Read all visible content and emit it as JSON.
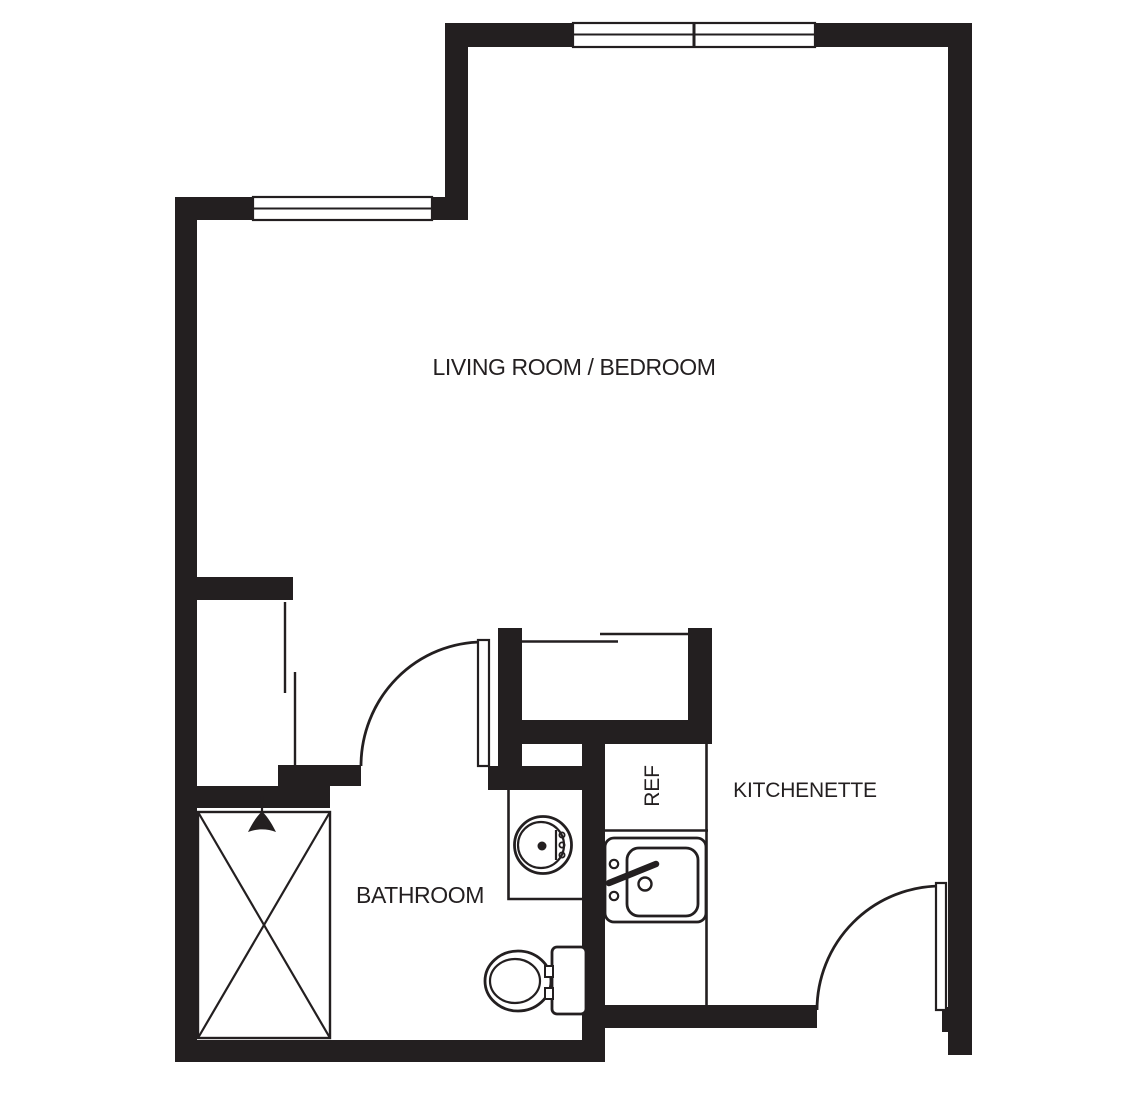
{
  "title": "Studio apartment floor plan",
  "colors": {
    "ink": "#231f20",
    "background": "#ffffff"
  },
  "rooms": {
    "living": {
      "label": "LIVING ROOM / BEDROOM"
    },
    "bathroom": {
      "label": "BATHROOM"
    },
    "kitchenette": {
      "label": "KITCHENETTE"
    },
    "refrigerator": {
      "label": "REF"
    }
  },
  "fixtures": [
    "shower-stall-with-x",
    "shower-head-icon",
    "toilet",
    "bathroom-round-sink",
    "kitchen-sink",
    "refrigerator-bay",
    "entry-door-swing",
    "bathroom-door-swing",
    "sliding-closet-doors-top",
    "sliding-closet-doors-left",
    "window-top",
    "window-left"
  ]
}
